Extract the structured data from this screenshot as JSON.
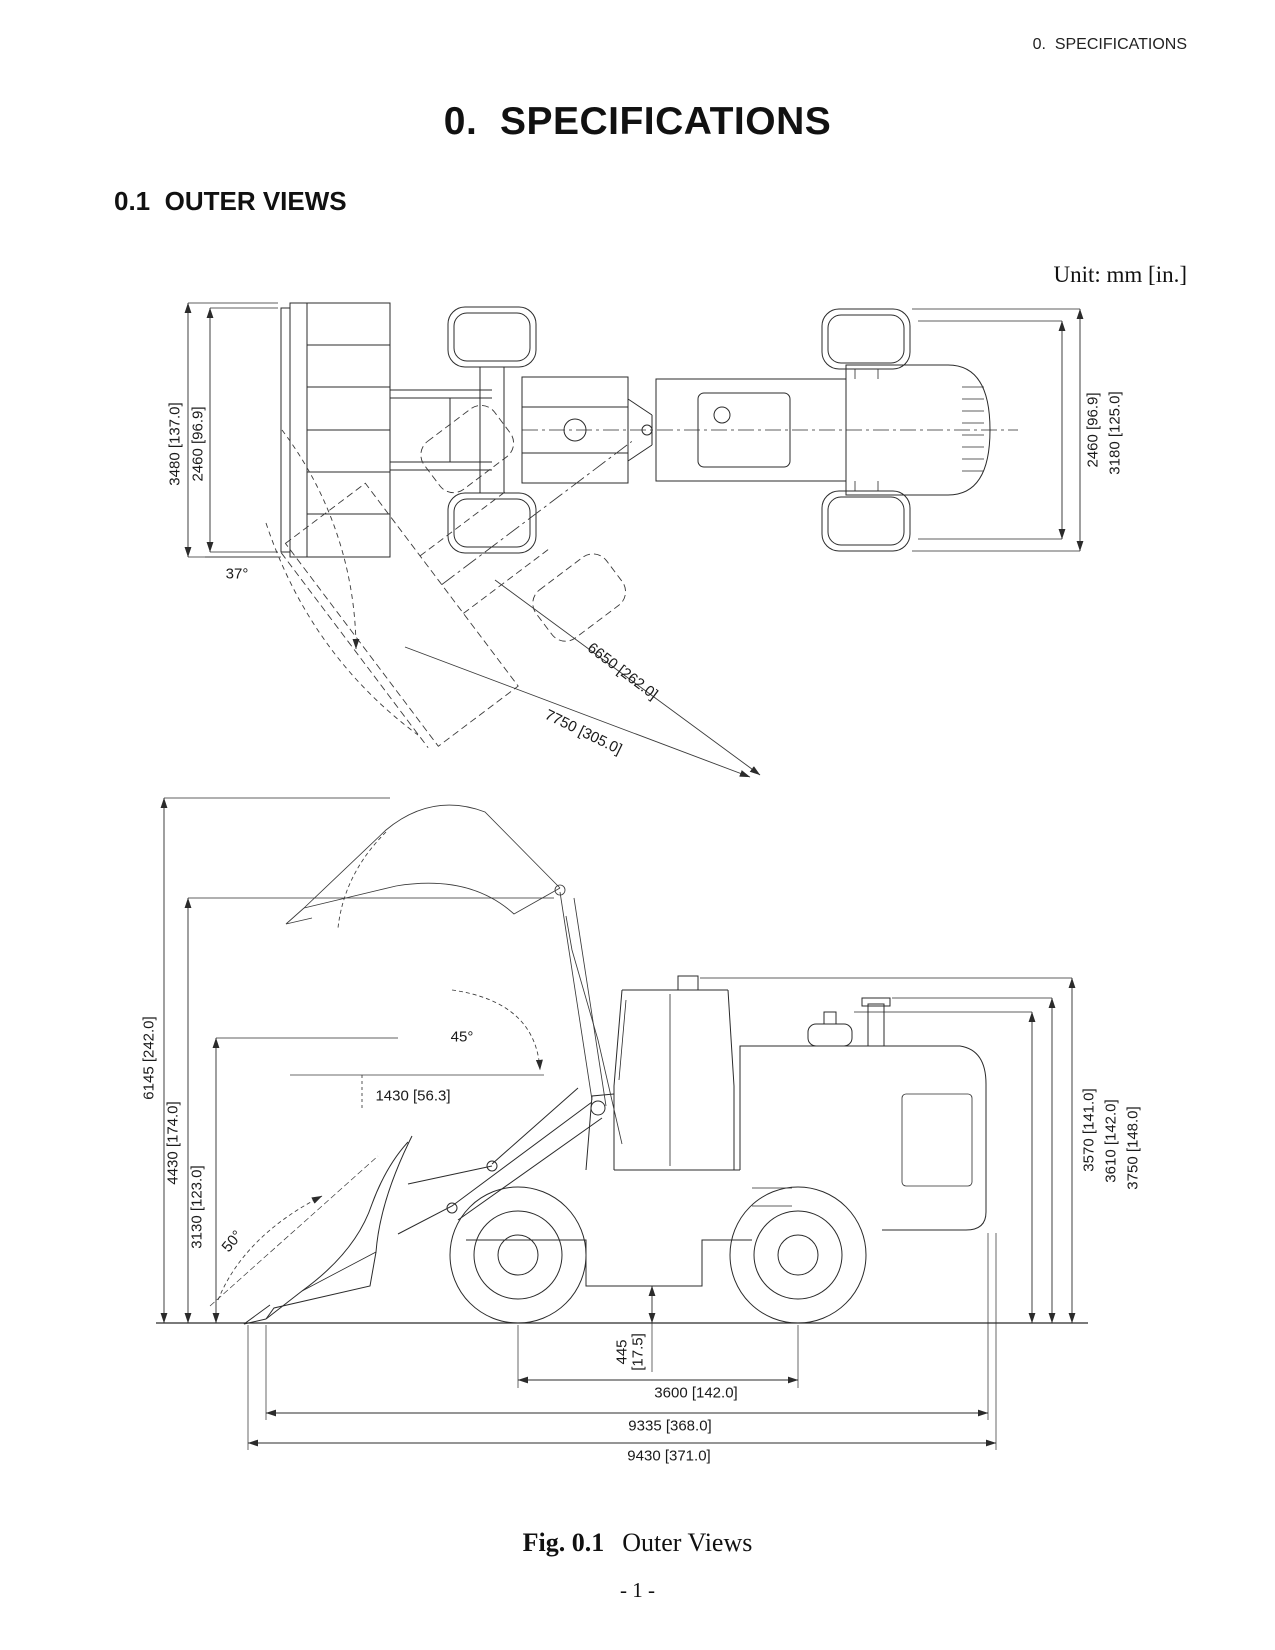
{
  "page": {
    "running_header": "0.  SPECIFICATIONS",
    "title": "0.  SPECIFICATIONS",
    "section_heading": "0.1  OUTER VIEWS",
    "unit_note": "Unit: mm [in.]",
    "caption_label": "Fig. 0.1",
    "caption_title": "Outer Views",
    "page_number": "- 1 -"
  },
  "figure": {
    "top_view": {
      "dim_left_outer": "3480 [137.0]",
      "dim_left_inner": "2460 [96.9]",
      "dim_right_inner": "2460 [96.9]",
      "dim_right_outer": "3180 [125.0]",
      "steering_angle": "37°",
      "dim_radius_inner": "6650 [262.0]",
      "dim_radius_outer": "7750 [305.0]"
    },
    "side_view": {
      "dim_height_max": "6145 [242.0]",
      "dim_height_hinge": "4430 [174.0]",
      "dim_height_dump": "3130 [123.0]",
      "angle_rollback": "50°",
      "angle_dump": "45°",
      "dim_reach": "1430 [56.3]",
      "dim_height_1": "3570 [141.0]",
      "dim_height_2": "3610 [142.0]",
      "dim_height_3": "3750 [148.0]",
      "clearance_mm": "445",
      "clearance_in": "[17.5]",
      "dim_wheelbase": "3600 [142.0]",
      "dim_length_1": "9335 [368.0]",
      "dim_length_2": "9430 [371.0]"
    }
  }
}
